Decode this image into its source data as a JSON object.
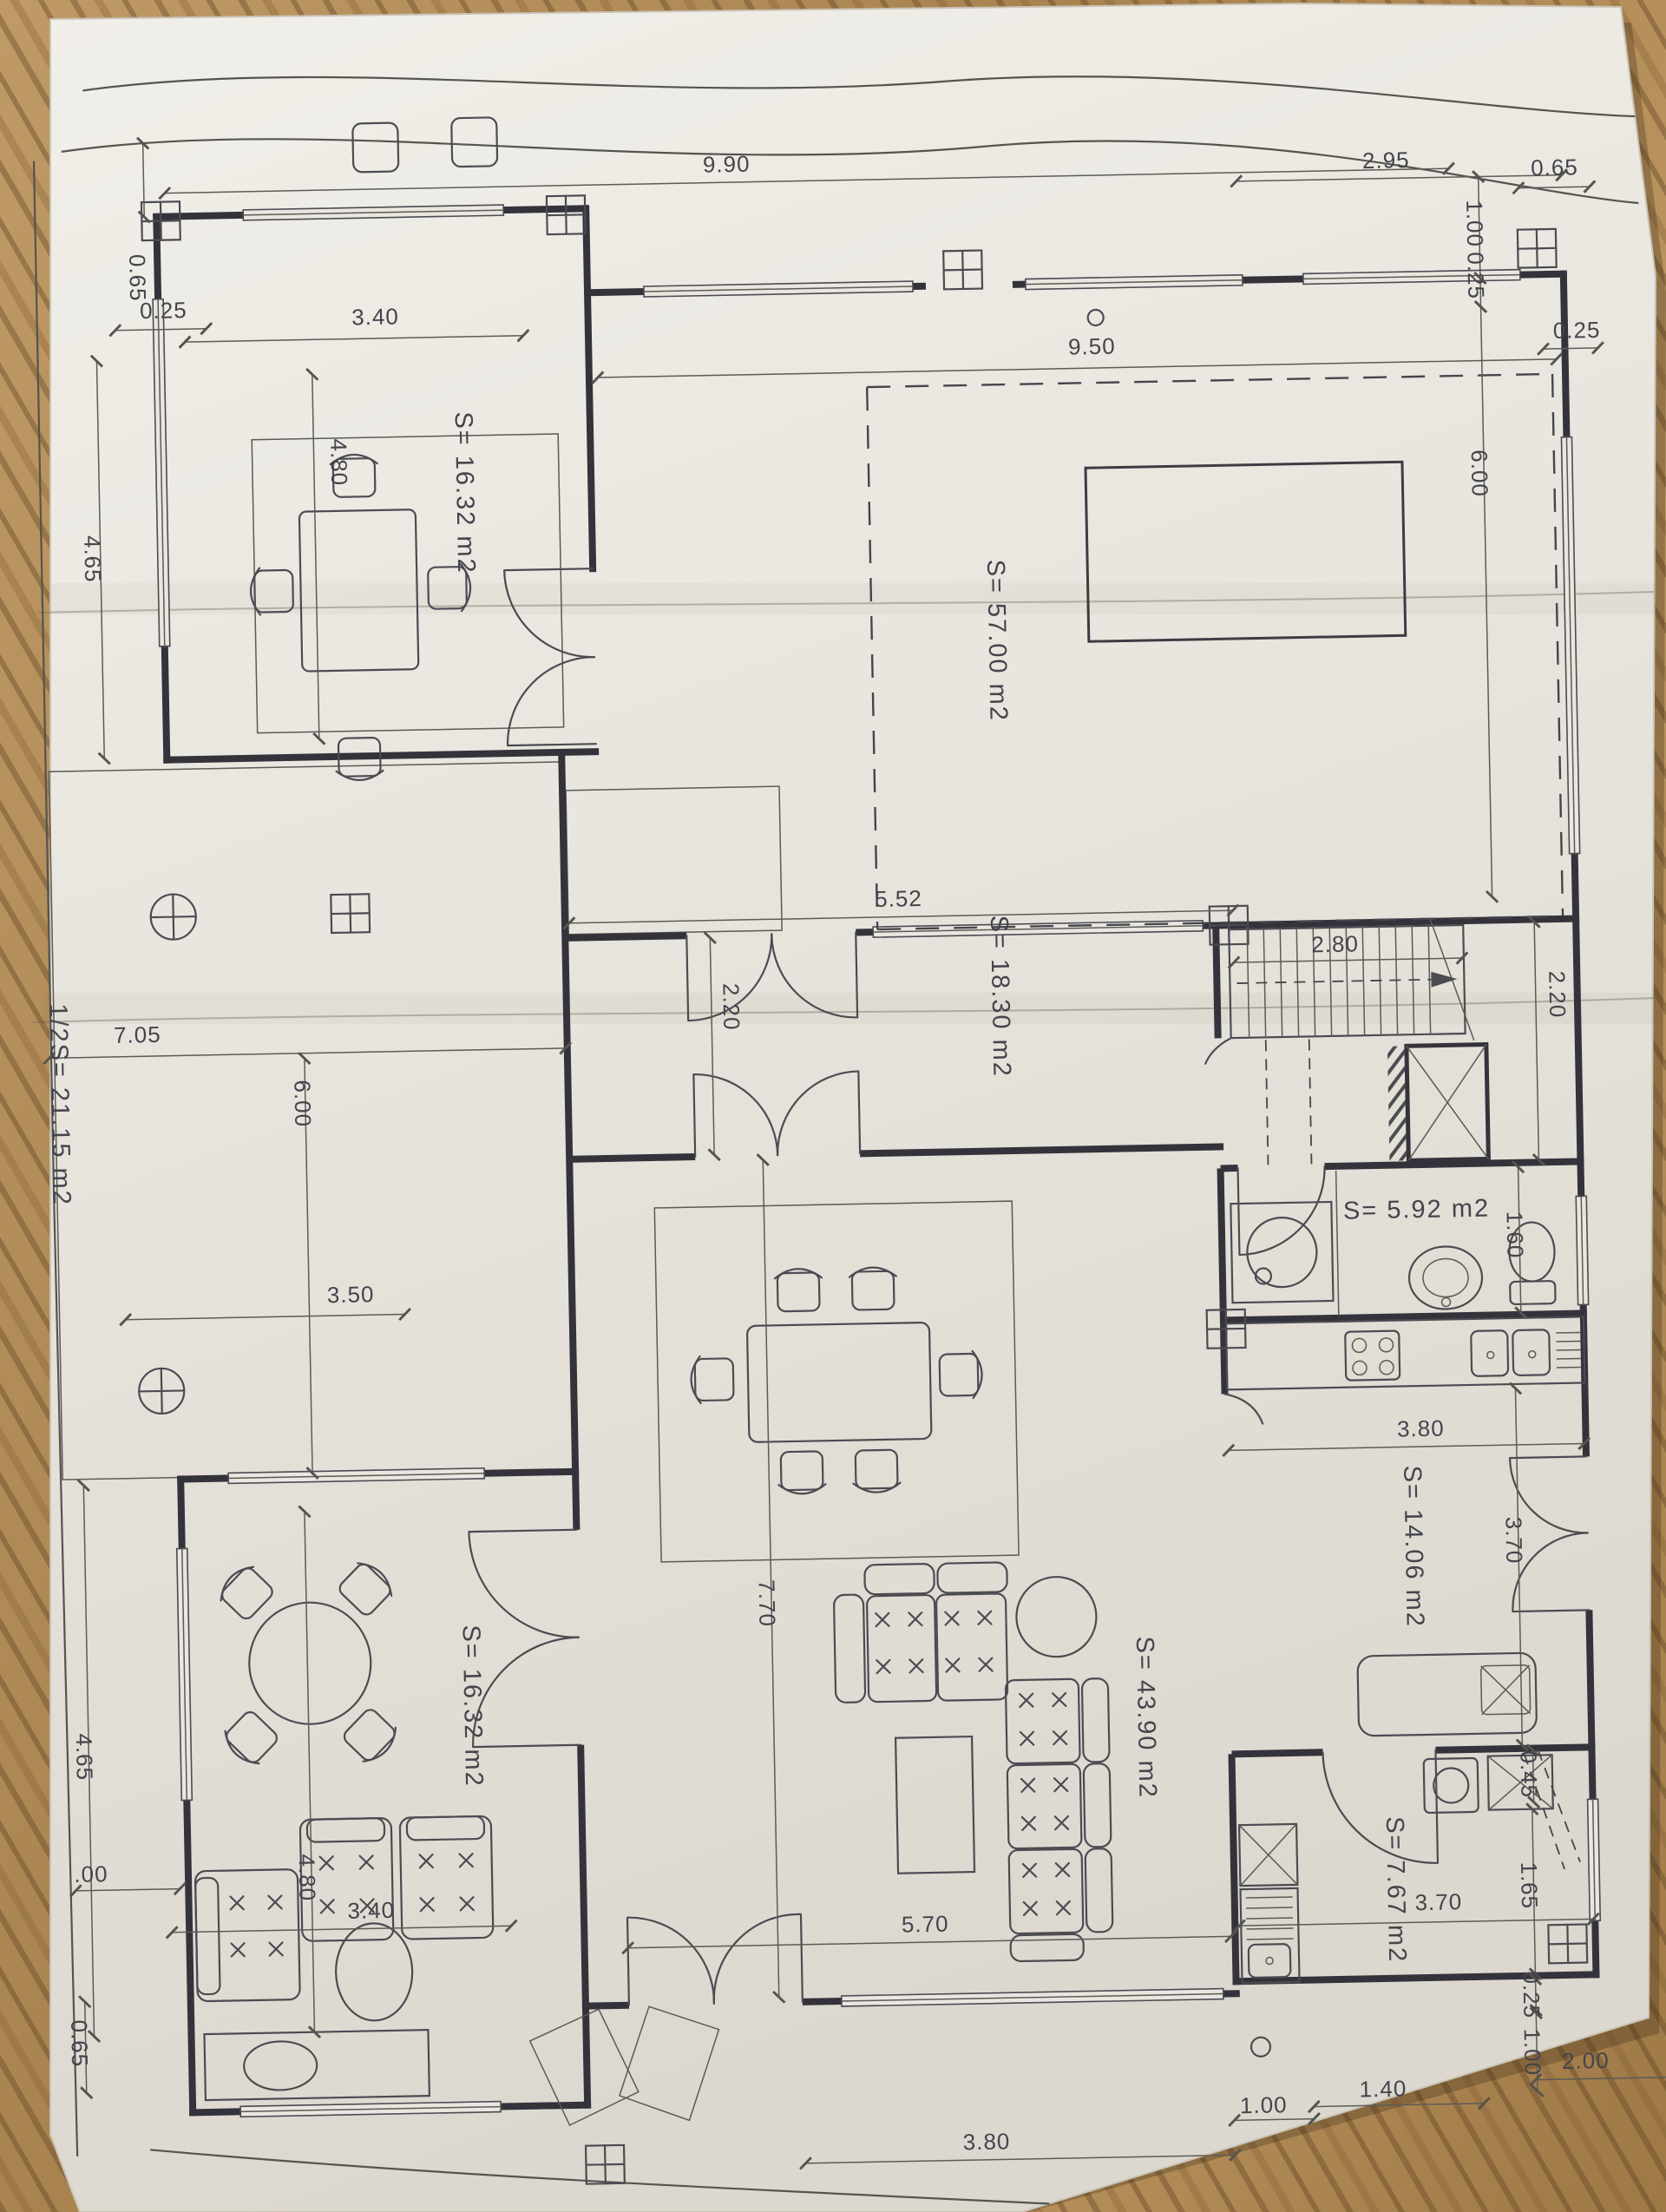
{
  "photo": {
    "subject": "architectural floor plan on paper",
    "surface": "wood-table"
  },
  "rooms": {
    "top_left_salon": {
      "label": "S= 16.32 m2"
    },
    "pool_terrace": {
      "label": "S= 57.00 m2"
    },
    "entry_hall": {
      "label": "S= 18.30 m2"
    },
    "bathroom": {
      "label": "S= 5.92 m2"
    },
    "kitchen": {
      "label": "S= 14.06 m2"
    },
    "living_room": {
      "label": "S= 43.90 m2"
    },
    "bottom_left_salon": {
      "label": "S= 16.32 m2"
    },
    "pantry": {
      "label": "S= 7.67 m2"
    },
    "side_terrace": {
      "label": "1/2S= 21.15 m2"
    }
  },
  "dims": [
    {
      "id": "site-top",
      "v": "9.90"
    },
    {
      "id": "left-offset-top",
      "v": "0.65"
    },
    {
      "id": "left-wall-top",
      "v": "0.25"
    },
    {
      "id": "left-room-a",
      "v": "4.65"
    },
    {
      "id": "room-a-width",
      "v": "3.40"
    },
    {
      "id": "room-a-depth",
      "v": "4.80"
    },
    {
      "id": "top-right-a",
      "v": "2.95"
    },
    {
      "id": "top-right-b",
      "v": "0.65"
    },
    {
      "id": "right-top-1",
      "v": "1.00"
    },
    {
      "id": "right-top-2",
      "v": "0.25"
    },
    {
      "id": "terrace-width",
      "v": "9.50"
    },
    {
      "id": "right-mid",
      "v": "0.25"
    },
    {
      "id": "terrace-height",
      "v": "6.00"
    },
    {
      "id": "side-terrace-w",
      "v": "7.05"
    },
    {
      "id": "side-terrace-h",
      "v": "6.00"
    },
    {
      "id": "side-terrace-w2",
      "v": "3.50"
    },
    {
      "id": "hall-width",
      "v": "5.52"
    },
    {
      "id": "stairs-width",
      "v": "2.80"
    },
    {
      "id": "hall-depth-l",
      "v": "2.20"
    },
    {
      "id": "hall-depth-r",
      "v": "2.20"
    },
    {
      "id": "bath-depth",
      "v": "1.60"
    },
    {
      "id": "kitchen-wall",
      "v": "3.80"
    },
    {
      "id": "kitchen-depth",
      "v": "3.70"
    },
    {
      "id": "niche",
      "v": "0.45"
    },
    {
      "id": "living-depth",
      "v": "7.70"
    },
    {
      "id": "living-width",
      "v": "5.70"
    },
    {
      "id": "salon-b-depth",
      "v": "4.80"
    },
    {
      "id": "salon-b-width",
      "v": "3.40"
    },
    {
      "id": "left-salon-b",
      "v": "4.65"
    },
    {
      "id": "left-bottom-frag",
      "v": ".00"
    },
    {
      "id": "left-bottom",
      "v": "0.65"
    },
    {
      "id": "pantry-h",
      "v": "1.65"
    },
    {
      "id": "pantry-w",
      "v": "3.70"
    },
    {
      "id": "br-1",
      "v": "0.25"
    },
    {
      "id": "br-2",
      "v": "1.00"
    },
    {
      "id": "br-3",
      "v": "2.00"
    },
    {
      "id": "bottom-r-1",
      "v": "1.40"
    },
    {
      "id": "bottom-r-2",
      "v": "1.00"
    },
    {
      "id": "bottom-center",
      "v": "3.80"
    }
  ]
}
